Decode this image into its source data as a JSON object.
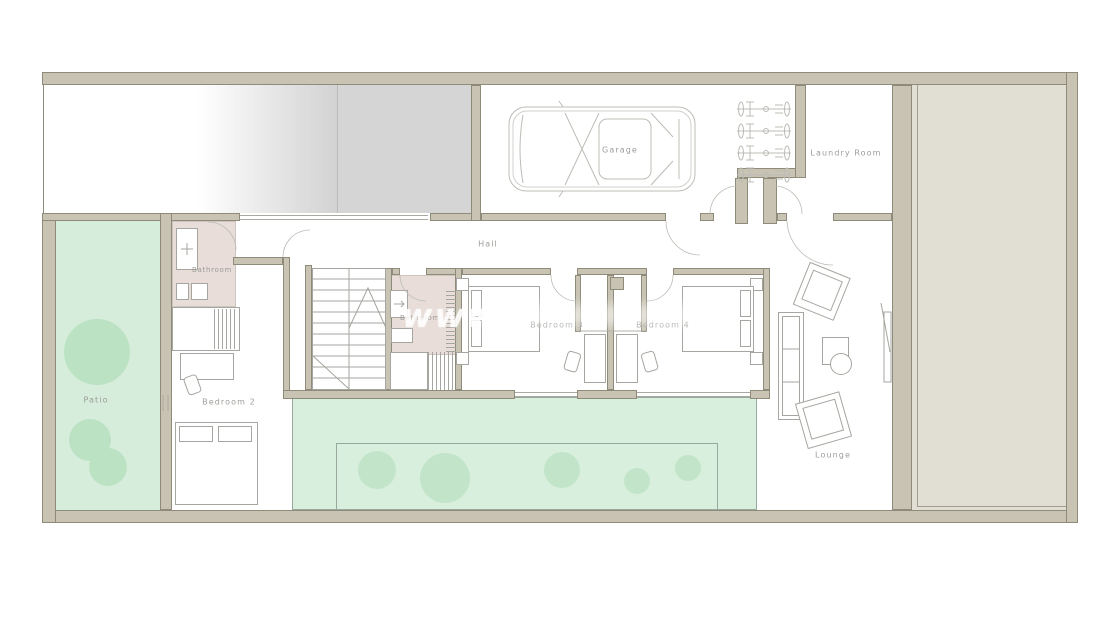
{
  "document": {
    "type": "architectural floor plan"
  },
  "watermark": {
    "text": "www"
  },
  "labels": [
    {
      "id": "garage",
      "text": "Garage"
    },
    {
      "id": "laundry",
      "text": "Laundry Room"
    },
    {
      "id": "hall",
      "text": "Hall"
    },
    {
      "id": "bathroom-1",
      "text": "Bathroom"
    },
    {
      "id": "bathroom-2",
      "text": "Bathroom"
    },
    {
      "id": "bedroom-2",
      "text": "Bedroom 2"
    },
    {
      "id": "bedroom-3",
      "text": "Bedroom 3"
    },
    {
      "id": "bedroom-4",
      "text": "Bedroom 4"
    },
    {
      "id": "patio",
      "text": "Patio"
    },
    {
      "id": "lounge",
      "text": "Lounge"
    }
  ],
  "colors": {
    "wall": "#c8c3b2",
    "wall_stroke": "#8f8b7b",
    "furn": "#a6a6a0",
    "furn_light": "#bcbcb6",
    "label": "#9c9c98",
    "pink": "#e8ddd8",
    "pink_stroke": "#cfc5bf",
    "patio": "#d6eddb",
    "tree": "#bce2c4",
    "garden": "#d8efde",
    "garden_stroke": "#99a89c",
    "bush": "#c2e5c9",
    "sideyard": "#e1ded3",
    "slab": "#d5d5d5",
    "line": "#a9a9a1"
  }
}
